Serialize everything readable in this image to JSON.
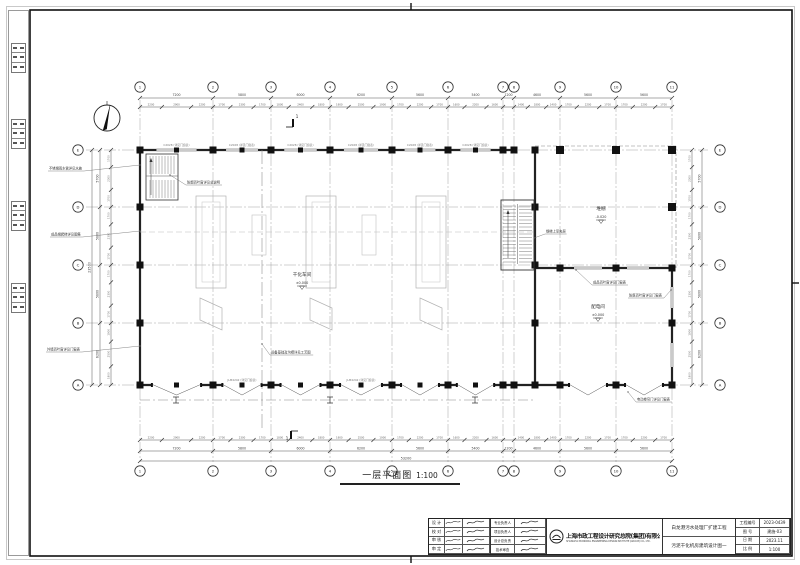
{
  "drawing_title": {
    "text": "一层平面图",
    "scale": "1:100"
  },
  "grid": {
    "x_labels": [
      "1",
      "2",
      "3",
      "4",
      "5",
      "6",
      "7",
      "8",
      "9",
      "10",
      "11"
    ],
    "x_px": [
      140,
      213,
      271,
      330,
      392,
      448,
      503,
      514,
      560,
      616,
      672
    ],
    "y_labels": [
      "E",
      "D",
      "C",
      "B",
      "A"
    ],
    "y_px": [
      150,
      207,
      265,
      323,
      385
    ]
  },
  "dimensions": {
    "x_bays": [
      "7200",
      "5800",
      "6000",
      "6200",
      "5600",
      "5400",
      "1200",
      "4600",
      "5600",
      "5600"
    ],
    "x_overall": "53200",
    "y_bays": [
      "5700",
      "5800",
      "5800",
      "6200"
    ],
    "y_overall": "23500"
  },
  "rooms": [
    {
      "name": "干化车间",
      "elev": "±0.000",
      "x": 302,
      "y": 276
    },
    {
      "name": "堆棚",
      "elev": "-0.020",
      "x": 601,
      "y": 210
    },
    {
      "name": "配电间",
      "elev": "±0.000",
      "x": 598,
      "y": 308
    }
  ],
  "annotations": [
    {
      "text": "不锈钢雨水管详见水施",
      "x": 48,
      "y": 170,
      "tx": 140,
      "ty": 165
    },
    {
      "text": "成品钢爬梯详见图集",
      "x": 50,
      "y": 236,
      "tx": 140,
      "ty": 231
    },
    {
      "text": "外墙百叶窗详见门窗表",
      "x": 46,
      "y": 351,
      "tx": 140,
      "ty": 346
    },
    {
      "text": "防烟百叶窗详见总说明",
      "x": 186,
      "y": 184,
      "tx": 170,
      "ty": 175
    },
    {
      "text": "钢梯上至夹层",
      "x": 545,
      "y": 233,
      "tx": 534,
      "ty": 238
    },
    {
      "text": "成品百叶窗详见门窗表",
      "x": 592,
      "y": 284,
      "tx": 576,
      "ty": 270
    },
    {
      "text": "防腐百叶窗详见门窗表",
      "x": 628,
      "y": 297,
      "tx": 671,
      "ty": 290
    },
    {
      "text": "电动卷帘门详见门窗表",
      "x": 636,
      "y": 401,
      "tx": 628,
      "ty": 392
    },
    {
      "text": "设备基础及沟槽详见工艺图",
      "x": 270,
      "y": 354,
      "tx": 262,
      "ty": 344
    }
  ],
  "tags": {
    "top_window": "C2028 (详见门窗表)",
    "bottom_door": "JLM4242 (详见门窗表)"
  },
  "section_mark": {
    "label": "1"
  },
  "north_arrow": {
    "name": "指北针"
  },
  "titleblock": {
    "company_cn": "上海市政工程设计研究总院(集团)有限公司",
    "company_en": "SHANGHAI MUNICIPAL ENGINEERING DESIGN INSTITUTE (GROUP) CO., LTD.",
    "project_name": "白龙港污水处理厂扩建工程",
    "sheet_name": "污泥干化机房建筑设计图一",
    "sig_rows_a": [
      "设 计",
      "校 对",
      "审 核",
      "审 定"
    ],
    "sig_rows_b": [
      "专业负责人",
      "项目负责人",
      "设计总负责",
      "技术审查"
    ],
    "info_rows": [
      {
        "label": "工程编号",
        "value": "2023-0439"
      },
      {
        "label": "图  号",
        "value": "建施-03"
      },
      {
        "label": "日  期",
        "value": "2023.11"
      },
      {
        "label": "比  例",
        "value": "1:100"
      }
    ]
  }
}
